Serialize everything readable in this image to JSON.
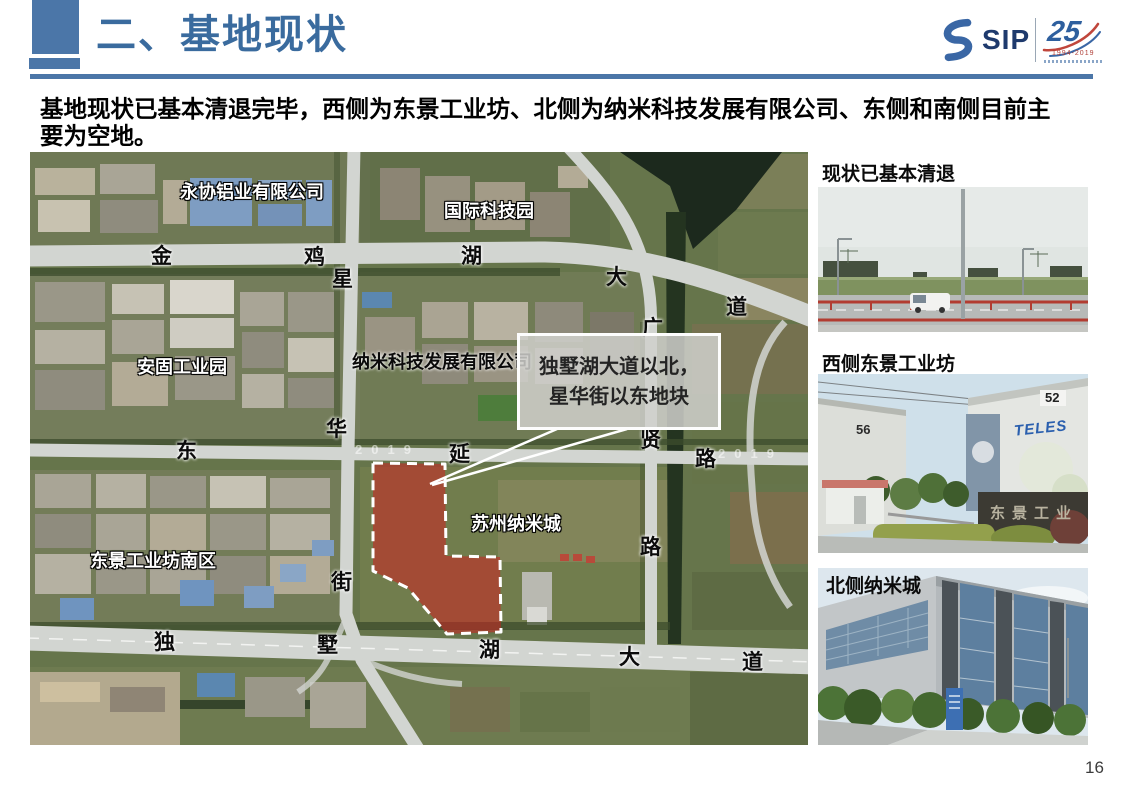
{
  "slide": {
    "title": "二、基地现状",
    "page_number": "16",
    "paragraph": "基地现状已基本清退完毕，西侧为东景工业坊、北侧为纳米科技发展有限公司、东侧和南侧目前主要为空地。",
    "logo": {
      "name": "SIP",
      "anniversary_number": "25",
      "anniversary_years": "1994-2019"
    },
    "colors": {
      "accent_blue": "#4b76a8",
      "title_blue": "#3a6b9e",
      "site_red": "#cc2323"
    }
  },
  "map": {
    "watermark": "2019",
    "callout": {
      "line1": "独墅湖大道以北，",
      "line2": "星华街以东地块"
    },
    "facility_labels": [
      {
        "text": "永协铝业有限公司"
      },
      {
        "text": "国际科技园"
      },
      {
        "text": "安固工业园"
      },
      {
        "text": "纳米科技发展有限公司"
      },
      {
        "text": "苏州纳米城"
      },
      {
        "text": "东景工业坊南区"
      }
    ],
    "road_labels": [
      {
        "text": "金"
      },
      {
        "text": "鸡"
      },
      {
        "text": "湖"
      },
      {
        "text": "大"
      },
      {
        "text": "道"
      },
      {
        "text": "星"
      },
      {
        "text": "华"
      },
      {
        "text": "街"
      },
      {
        "text": "东"
      },
      {
        "text": "延"
      },
      {
        "text": "路"
      },
      {
        "text": "广"
      },
      {
        "text": "贤"
      },
      {
        "text": "路"
      },
      {
        "text": "独"
      },
      {
        "text": "墅"
      },
      {
        "text": "湖"
      },
      {
        "text": "大"
      },
      {
        "text": "道"
      }
    ]
  },
  "photos": [
    {
      "caption": "现状已基本清退"
    },
    {
      "caption": "西侧东景工业坊",
      "building_no_left": "56",
      "building_no_right": "52",
      "brand": "TELES",
      "gate_sign": "东景工业"
    },
    {
      "caption": "北侧纳米城"
    }
  ]
}
